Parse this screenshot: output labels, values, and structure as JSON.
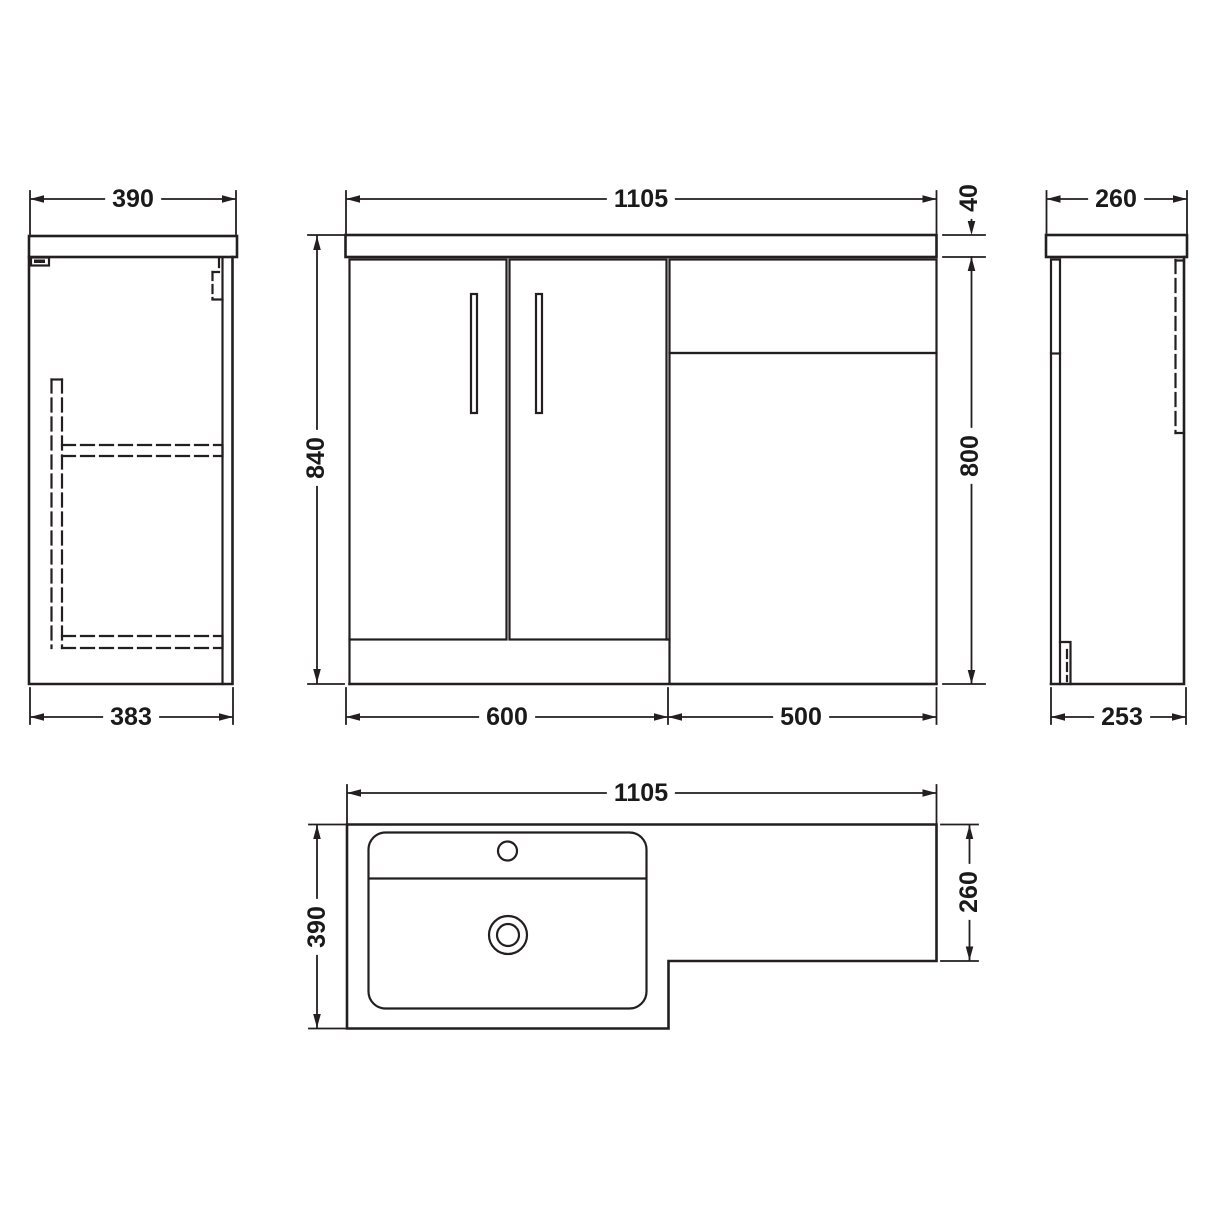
{
  "colors": {
    "line": "#231f20",
    "text": "#1a1a1a",
    "background": "#ffffff"
  },
  "dims": {
    "left_view": {
      "counter_depth": "390",
      "cabinet_depth": "383"
    },
    "front_view": {
      "overall_width": "1105",
      "overall_height": "840",
      "counter_thickness": "40",
      "cabinet_height": "800",
      "vanity_unit_width": "600",
      "wc_unit_width": "500"
    },
    "right_view": {
      "counter_depth": "260",
      "cabinet_depth": "253"
    },
    "plan_view": {
      "overall_width": "1105",
      "counter_depth": "390",
      "wc_return_depth": "260"
    }
  }
}
